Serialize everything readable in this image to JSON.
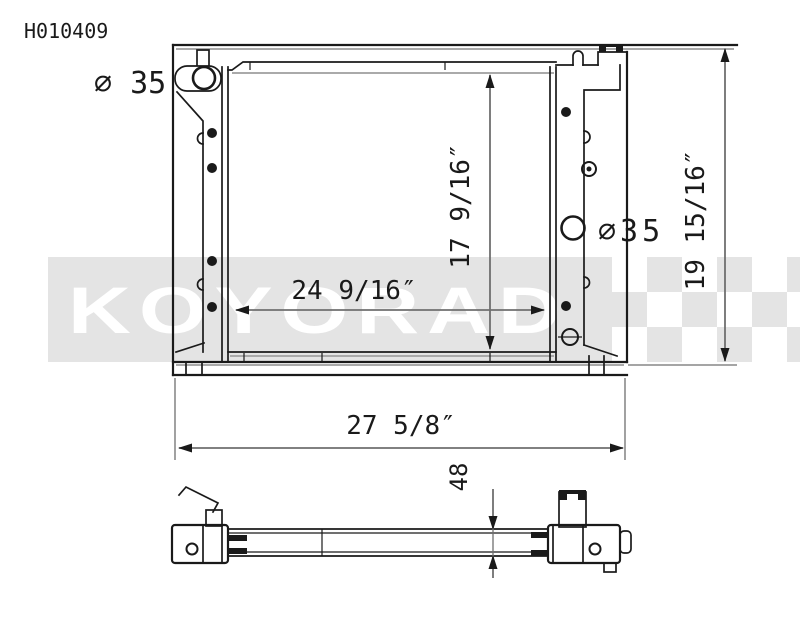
{
  "part_number": "H010409",
  "watermark": {
    "brand": "KOYORAD",
    "band_color": "#e4e4e4",
    "letter_color": "#ffffff"
  },
  "colors": {
    "line": "#1a1a1a",
    "dimension_line": "#6f6f6f",
    "background": "#ffffff"
  },
  "front_view": {
    "left_port_diameter": "⌀ 35",
    "right_port_diameter": "⌀35",
    "core_width": "24 9/16″",
    "core_height": "17 9/16″",
    "overall_width": "27 5/8″",
    "overall_height": "19 15/16″"
  },
  "bottom_view": {
    "core_thickness": "48"
  }
}
